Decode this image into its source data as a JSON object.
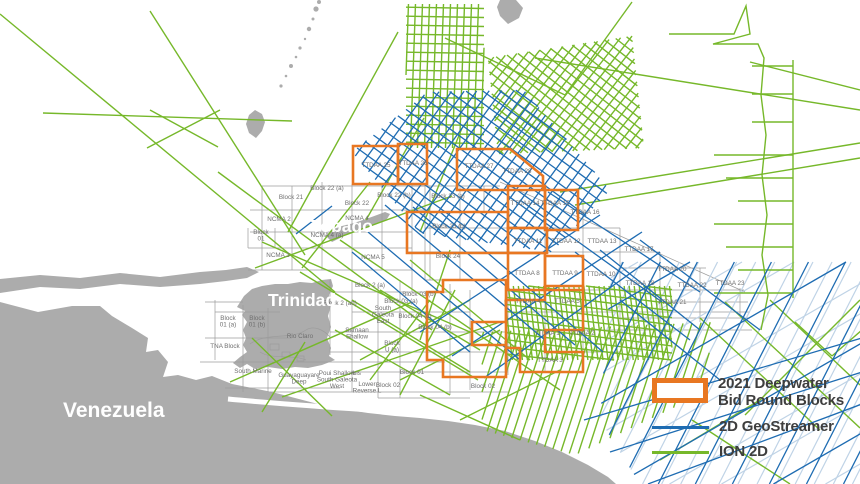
{
  "colors": {
    "sea": "#FFFFFF",
    "land": "#ACACAC",
    "block_outline": "#9C9C9C",
    "block_label": "#6E6E6E",
    "bid_blocks": "#E87722",
    "geostreamer": "#1E6CB2",
    "geostreamer_light": "#BFD3E6",
    "ion2d": "#76B82A",
    "place_label": "#FFFFFF",
    "legend_text": "#3E3E3E"
  },
  "place_labels": [
    {
      "text": "Venezuela",
      "x": 63,
      "y": 417,
      "size": 21
    },
    {
      "text": "Trinidad",
      "x": 268,
      "y": 306,
      "size": 17.5
    },
    {
      "text": "Tobago",
      "x": 311,
      "y": 232,
      "size": 17.5
    }
  ],
  "block_labels": [
    {
      "text": "Block 21",
      "x": 291,
      "y": 199
    },
    {
      "text": "Block 22 (a)",
      "x": 327,
      "y": 190
    },
    {
      "text": "Block 22",
      "x": 357,
      "y": 205
    },
    {
      "text": "Block 22 (b)",
      "x": 394,
      "y": 197
    },
    {
      "text": "NCMA 2",
      "x": 279,
      "y": 221
    },
    {
      "text": "NCMA 4",
      "x": 357,
      "y": 220
    },
    {
      "text": "NCMA 4 (a)",
      "x": 327,
      "y": 237
    },
    {
      "lines": [
        "Block",
        "01"
      ],
      "x": 261,
      "y": 234
    },
    {
      "text": "NCMA 3",
      "x": 278,
      "y": 257
    },
    {
      "text": "NCMA 5",
      "x": 373,
      "y": 259
    },
    {
      "text": "Block 23 (a)",
      "x": 448,
      "y": 198
    },
    {
      "text": "Block 23 (b)",
      "x": 449,
      "y": 228
    },
    {
      "text": "Block 24",
      "x": 448,
      "y": 258
    },
    {
      "text": "Block 2 (a)",
      "x": 370,
      "y": 287
    },
    {
      "text": "Block 2 (ab)",
      "x": 340,
      "y": 305
    },
    {
      "text": "Block 03 (a)",
      "x": 401,
      "y": 303
    },
    {
      "text": "Block 03 (b)",
      "x": 419,
      "y": 296
    },
    {
      "lines": [
        "South",
        "Galeota",
        "East"
      ],
      "x": 383,
      "y": 310
    },
    {
      "text": "Block 04 (c)",
      "x": 415,
      "y": 318
    },
    {
      "text": "Block 04 (b)",
      "x": 435,
      "y": 329
    },
    {
      "lines": [
        "Samaan",
        "Shallow"
      ],
      "x": 357,
      "y": 332
    },
    {
      "lines": [
        "Block",
        "U (a)"
      ],
      "x": 392,
      "y": 345
    },
    {
      "text": "Rio Claro",
      "x": 300,
      "y": 338
    },
    {
      "text": "TNA Block",
      "x": 225,
      "y": 348
    },
    {
      "lines": [
        "Block",
        "01 (a)"
      ],
      "x": 228,
      "y": 320
    },
    {
      "lines": [
        "Block",
        "01 (b)"
      ],
      "x": 257,
      "y": 320
    },
    {
      "text": "South Marine",
      "x": 253,
      "y": 373
    },
    {
      "lines": [
        "Guayaguayare",
        "Deep"
      ],
      "x": 299,
      "y": 377
    },
    {
      "lines": [
        "Poui Shallow",
        "South Galeota",
        "West"
      ],
      "x": 337,
      "y": 375
    },
    {
      "text": "Ibis",
      "x": 356,
      "y": 375
    },
    {
      "lines": [
        "Lower",
        "Reverse L"
      ],
      "x": 367,
      "y": 386
    },
    {
      "text": "Block 02",
      "x": 388,
      "y": 387
    },
    {
      "text": "Block 01",
      "x": 412,
      "y": 374
    },
    {
      "text": "Block 02",
      "x": 483,
      "y": 388
    },
    {
      "text": "TTDAA 25",
      "x": 376,
      "y": 167
    },
    {
      "text": "TTDAA 26",
      "x": 413,
      "y": 165
    },
    {
      "text": "TTDAA 27",
      "x": 479,
      "y": 168
    },
    {
      "text": "TTDAA 28",
      "x": 517,
      "y": 173
    },
    {
      "text": "TTDAA 14",
      "x": 525,
      "y": 205
    },
    {
      "text": "TTDAA 15",
      "x": 555,
      "y": 205
    },
    {
      "text": "TTDAA 16",
      "x": 585,
      "y": 214
    },
    {
      "text": "TTDAA 11",
      "x": 528,
      "y": 243
    },
    {
      "text": "TTDAA 12",
      "x": 566,
      "y": 243
    },
    {
      "text": "TTDAA 13",
      "x": 602,
      "y": 243
    },
    {
      "text": "TTDAA 17",
      "x": 639,
      "y": 251
    },
    {
      "text": "TTDAA 8",
      "x": 527,
      "y": 275
    },
    {
      "text": "TTDAA 9",
      "x": 565,
      "y": 275
    },
    {
      "text": "TTDAA 10",
      "x": 601,
      "y": 276
    },
    {
      "text": "TTDAA 20",
      "x": 672,
      "y": 271
    },
    {
      "text": "TTDAA 18",
      "x": 640,
      "y": 285
    },
    {
      "text": "TTDAA 22",
      "x": 692,
      "y": 287
    },
    {
      "text": "TTDAA 23",
      "x": 730,
      "y": 285
    },
    {
      "text": "TTDAA 21",
      "x": 672,
      "y": 304
    },
    {
      "text": "TTDAA 4",
      "x": 528,
      "y": 303
    },
    {
      "text": "TTDAA 5",
      "x": 567,
      "y": 303
    },
    {
      "text": "TTDAA 1",
      "x": 547,
      "y": 335
    },
    {
      "text": "TTDAA 2",
      "x": 582,
      "y": 335
    },
    {
      "text": "TTDAA 3",
      "x": 550,
      "y": 362
    }
  ],
  "legend": {
    "items": [
      {
        "label": "2021 Deepwater Bid Round Blocks",
        "swatch": "rect",
        "color": "#E87722"
      },
      {
        "label": "2D GeoStreamer",
        "swatch": "line",
        "color": "#1E6CB2"
      },
      {
        "label": "ION 2D",
        "swatch": "line",
        "color": "#76B82A"
      }
    ]
  }
}
